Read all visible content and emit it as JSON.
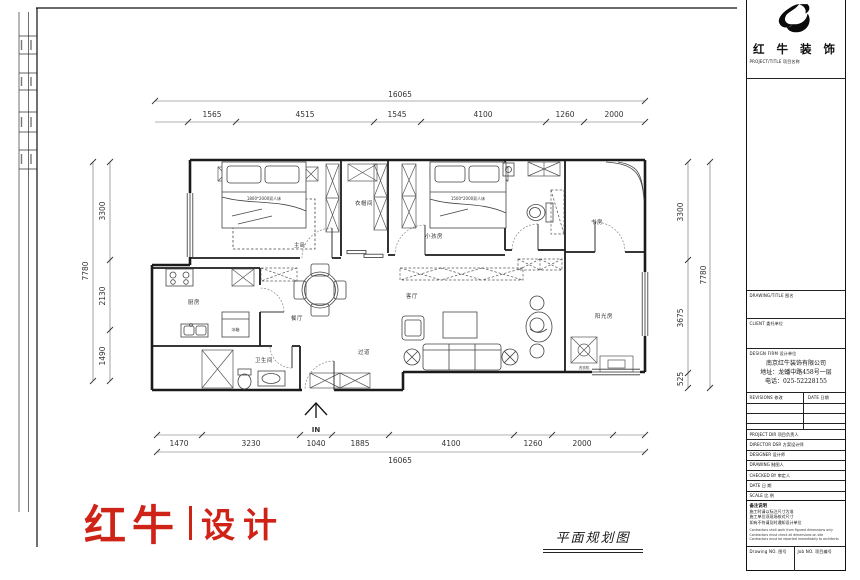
{
  "brand": {
    "logo_cn": "红牛",
    "logo_suffix": "设计",
    "color": "#cf2318"
  },
  "sheet": {
    "plan_title": "平面规划图"
  },
  "plan": {
    "entry_label": "IN",
    "rooms": {
      "master": "主卧",
      "closet": "衣帽间",
      "kids": "小孩房",
      "study": "书房",
      "sunroom": "阳光房",
      "living": "客厅",
      "dining": "餐厅",
      "hall": "过道",
      "kitchen": "厨房",
      "bath": "卫生间"
    },
    "furniture": {
      "bed_master": "1800*2000双人床",
      "bed_kids": "1500*2000双人床",
      "fridge": "冰箱",
      "washer": "洗衣机"
    },
    "dims": {
      "top_total": "16065",
      "top": [
        "1565",
        "4515",
        "1545",
        "4100",
        "1260",
        "2000"
      ],
      "bottom": [
        "1470",
        "3230",
        "1040",
        "1885",
        "4100",
        "1260",
        "2000"
      ],
      "bottom_total": "16065",
      "left": [
        "3300",
        "2130",
        "1490"
      ],
      "left_total": "7780",
      "right": [
        "3300",
        "3675",
        "525"
      ],
      "right_total": "7780"
    }
  },
  "title_block": {
    "company_logo_text": "红 牛 装 饰",
    "fields": {
      "project_title": "PROJECT/TITLE 项目名称",
      "drawing_title": "DRAWING/TITLE 图名",
      "client": "CLIENT 委托单位",
      "design_firm": "DESIGN FIRM 设计单位",
      "revisions": "REVISIONS 修改",
      "date_col": "DATE 日期",
      "project_dir": "PROJECT DIR 项目负责人",
      "director": "DIRECTOR DSR 方案设计师",
      "designer": "DESIGNER 设计师",
      "drawing_by": "DRAWING 制图人",
      "checked_by": "CHECKED BY 审定人",
      "date": "DATE 日 期",
      "scale": "SCALE 比 例",
      "drawing_no": "Drawing NO. 图号",
      "job_no": "Job NO. 项目编号"
    },
    "firm_info": {
      "name": "南京红牛装饰有限公司",
      "address": "地址：龙蟠中路458号一层",
      "phone": "电话：025-52228155"
    },
    "notes_title": "备注说明",
    "notes_cn": [
      "施工时请以标注尺寸为准",
      "施工单位须现场核对尺寸",
      "如有不符请及时通知设计单位"
    ],
    "notes_en": [
      "Contractors shall work from figured dimensions only",
      "Contractors must check all dimensions on site",
      "Contractors must be reported immediately to architects"
    ]
  }
}
